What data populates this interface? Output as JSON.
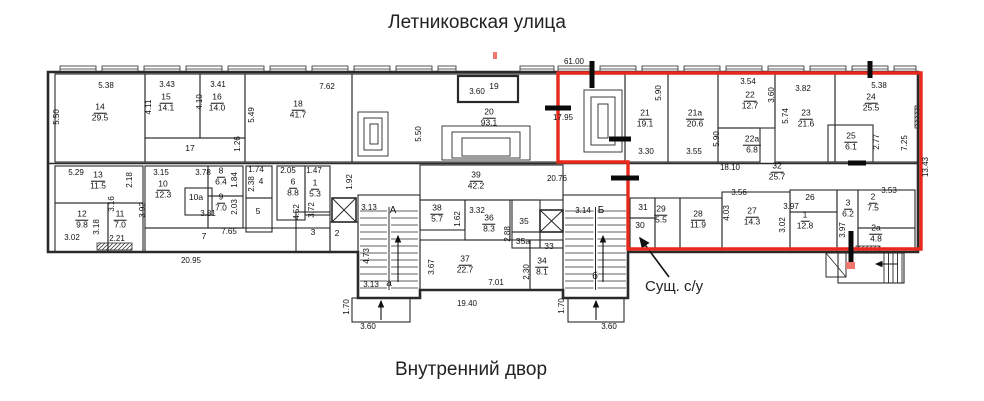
{
  "titles": {
    "top": "Летниковская улица",
    "bottom": "Внутренний двор"
  },
  "callout": {
    "text": "Сущ. с/у"
  },
  "colors": {
    "highlight": "#e8291c",
    "wall": "#2a2a2a",
    "accentTick": "#f0766e"
  },
  "plan": {
    "outline_path": "M48 72 H918 V252 H628 V298 H563 V290 H420 V298 H358 V252 H48 Z",
    "red_outline_points": "558,73 921,73 921,249 628,249 628,162 558,162",
    "rooms": [
      {
        "id": "room-14",
        "x": 55,
        "y": 74,
        "w": 90,
        "h": 88
      },
      {
        "id": "room-15",
        "x": 145,
        "y": 74,
        "w": 55,
        "h": 64
      },
      {
        "id": "room-16",
        "x": 200,
        "y": 74,
        "w": 45,
        "h": 64
      },
      {
        "id": "corridor-17",
        "x": 145,
        "y": 138,
        "w": 100,
        "h": 24
      },
      {
        "id": "room-18",
        "x": 245,
        "y": 74,
        "w": 107,
        "h": 88
      },
      {
        "id": "hall-20",
        "x": 352,
        "y": 74,
        "w": 273,
        "h": 88
      },
      {
        "id": "entrance-19",
        "x": 458,
        "y": 76,
        "w": 60,
        "h": 26,
        "bold": true
      },
      {
        "id": "room-21",
        "x": 625,
        "y": 74,
        "w": 43,
        "h": 88
      },
      {
        "id": "room-21a",
        "x": 668,
        "y": 74,
        "w": 50,
        "h": 88
      },
      {
        "id": "room-22",
        "x": 718,
        "y": 74,
        "w": 57,
        "h": 54
      },
      {
        "id": "room-22a",
        "x": 718,
        "y": 128,
        "w": 42,
        "h": 34
      },
      {
        "id": "room-23",
        "x": 775,
        "y": 74,
        "w": 60,
        "h": 88
      },
      {
        "id": "room-24",
        "x": 835,
        "y": 74,
        "w": 83,
        "h": 88
      },
      {
        "id": "room-25",
        "x": 828,
        "y": 125,
        "w": 45,
        "h": 37
      },
      {
        "id": "room-13",
        "x": 55,
        "y": 166,
        "w": 88,
        "h": 37
      },
      {
        "id": "room-12",
        "x": 55,
        "y": 203,
        "w": 53,
        "h": 49
      },
      {
        "id": "room-11",
        "x": 108,
        "y": 203,
        "w": 35,
        "h": 49
      },
      {
        "id": "room-10",
        "x": 145,
        "y": 166,
        "w": 63,
        "h": 62
      },
      {
        "id": "room-10a",
        "x": 185,
        "y": 188,
        "w": 27,
        "h": 27
      },
      {
        "id": "room-8",
        "x": 208,
        "y": 166,
        "w": 35,
        "h": 30
      },
      {
        "id": "room-9",
        "x": 208,
        "y": 196,
        "w": 35,
        "h": 32
      },
      {
        "id": "room-4",
        "x": 246,
        "y": 166,
        "w": 26,
        "h": 32
      },
      {
        "id": "room-5",
        "x": 246,
        "y": 198,
        "w": 26,
        "h": 34
      },
      {
        "id": "room-6",
        "x": 277,
        "y": 166,
        "w": 28,
        "h": 54
      },
      {
        "id": "room-1-left",
        "x": 305,
        "y": 166,
        "w": 25,
        "h": 49
      },
      {
        "id": "corridor-7",
        "x": 145,
        "y": 228,
        "w": 185,
        "h": 24
      },
      {
        "id": "room-3-left",
        "x": 296,
        "y": 212,
        "w": 34,
        "h": 40
      },
      {
        "id": "room-2-left",
        "x": 330,
        "y": 222,
        "w": 28,
        "h": 30
      },
      {
        "id": "stairs-a-box",
        "x": 358,
        "y": 195,
        "w": 62,
        "h": 103
      },
      {
        "id": "hall-39",
        "x": 420,
        "y": 165,
        "w": 143,
        "h": 35
      },
      {
        "id": "room-38",
        "x": 420,
        "y": 200,
        "w": 45,
        "h": 30
      },
      {
        "id": "room-36",
        "x": 465,
        "y": 200,
        "w": 45,
        "h": 40
      },
      {
        "id": "room-35",
        "x": 512,
        "y": 200,
        "w": 28,
        "h": 32
      },
      {
        "id": "room-35a",
        "x": 512,
        "y": 232,
        "w": 28,
        "h": 16
      },
      {
        "id": "room-33",
        "x": 540,
        "y": 232,
        "w": 23,
        "h": 16
      },
      {
        "id": "room-37",
        "x": 420,
        "y": 240,
        "w": 110,
        "h": 50
      },
      {
        "id": "room-34",
        "x": 530,
        "y": 240,
        "w": 33,
        "h": 50
      },
      {
        "id": "stairs-b-box",
        "x": 563,
        "y": 195,
        "w": 65,
        "h": 103
      },
      {
        "id": "room-31",
        "x": 630,
        "y": 198,
        "w": 25,
        "h": 20
      },
      {
        "id": "room-30",
        "x": 630,
        "y": 218,
        "w": 25,
        "h": 34
      },
      {
        "id": "room-29",
        "x": 655,
        "y": 198,
        "w": 25,
        "h": 54
      },
      {
        "id": "room-28",
        "x": 680,
        "y": 198,
        "w": 42,
        "h": 54
      },
      {
        "id": "room-27",
        "x": 722,
        "y": 192,
        "w": 68,
        "h": 60
      },
      {
        "id": "room-26",
        "x": 790,
        "y": 190,
        "w": 47,
        "h": 22
      },
      {
        "id": "room-1-right",
        "x": 790,
        "y": 212,
        "w": 47,
        "h": 40
      },
      {
        "id": "room-3-right",
        "x": 837,
        "y": 190,
        "w": 21,
        "h": 62
      },
      {
        "id": "room-2-right",
        "x": 858,
        "y": 190,
        "w": 57,
        "h": 38
      },
      {
        "id": "room-2a",
        "x": 858,
        "y": 228,
        "w": 57,
        "h": 24
      },
      {
        "id": "porch-a",
        "x": 352,
        "y": 298,
        "w": 58,
        "h": 24
      },
      {
        "id": "porch-b",
        "x": 568,
        "y": 298,
        "w": 56,
        "h": 24
      },
      {
        "id": "porch-right",
        "x": 838,
        "y": 253,
        "w": 66,
        "h": 30
      }
    ],
    "room_labels": [
      {
        "num": "14",
        "area": "29.5",
        "x": 100,
        "y": 113
      },
      {
        "num": "15",
        "area": "14.1",
        "x": 166,
        "y": 103
      },
      {
        "num": "16",
        "area": "14.0",
        "x": 217,
        "y": 103
      },
      {
        "num": "18",
        "area": "41.7",
        "x": 298,
        "y": 110
      },
      {
        "num": "20",
        "area": "93.1",
        "x": 489,
        "y": 118
      },
      {
        "num": "21",
        "area": "19.1",
        "x": 645,
        "y": 119
      },
      {
        "num": "21а",
        "area": "20.6",
        "x": 695,
        "y": 119
      },
      {
        "num": "22",
        "area": "12.7",
        "x": 750,
        "y": 101
      },
      {
        "num": "22а",
        "area": "6.8",
        "x": 752,
        "y": 145
      },
      {
        "num": "23",
        "area": "21.6",
        "x": 806,
        "y": 119
      },
      {
        "num": "24",
        "area": "25.5",
        "x": 871,
        "y": 103
      },
      {
        "num": "25",
        "area": "6.1",
        "x": 851,
        "y": 142
      },
      {
        "num": "32",
        "area": "25.7",
        "x": 777,
        "y": 172
      },
      {
        "num": "13",
        "area": "11.5",
        "x": 98,
        "y": 181
      },
      {
        "num": "12",
        "area": "9.8",
        "x": 82,
        "y": 220
      },
      {
        "num": "11",
        "area": "7.0",
        "x": 120,
        "y": 220
      },
      {
        "num": "10",
        "area": "12.3",
        "x": 163,
        "y": 190
      },
      {
        "num": "8",
        "area": "6.4",
        "x": 221,
        "y": 177
      },
      {
        "num": "9",
        "area": "7.0",
        "x": 221,
        "y": 203
      },
      {
        "num": "6",
        "area": "8.8",
        "x": 293,
        "y": 188
      },
      {
        "num": "1",
        "area": "5.3",
        "x": 315,
        "y": 189
      },
      {
        "num": "39",
        "area": "42.2",
        "x": 476,
        "y": 181
      },
      {
        "num": "38",
        "area": "5.7",
        "x": 437,
        "y": 214
      },
      {
        "num": "36",
        "area": "8.3",
        "x": 489,
        "y": 224
      },
      {
        "num": "37",
        "area": "22.7",
        "x": 465,
        "y": 265
      },
      {
        "num": "34",
        "area": "8.1",
        "x": 542,
        "y": 267
      },
      {
        "num": "29",
        "area": "5.5",
        "x": 661,
        "y": 215
      },
      {
        "num": "28",
        "area": "11.9",
        "x": 698,
        "y": 220
      },
      {
        "num": "27",
        "area": "14.3",
        "x": 752,
        "y": 217
      },
      {
        "num": "1",
        "area": "12.8",
        "x": 805,
        "y": 221
      },
      {
        "num": "3",
        "area": "6.2",
        "x": 848,
        "y": 209
      },
      {
        "num": "2",
        "area": "7.5",
        "x": 873,
        "y": 203
      },
      {
        "num": "2а",
        "area": "4.8",
        "x": 876,
        "y": 234
      }
    ],
    "plain_labels": [
      {
        "text": "17",
        "x": 190,
        "y": 148
      },
      {
        "text": "19",
        "x": 494,
        "y": 86
      },
      {
        "text": "10а",
        "x": 196,
        "y": 197
      },
      {
        "text": "4",
        "x": 261,
        "y": 181
      },
      {
        "text": "5",
        "x": 258,
        "y": 211
      },
      {
        "text": "7",
        "x": 204,
        "y": 236
      },
      {
        "text": "3",
        "x": 313,
        "y": 232
      },
      {
        "text": "2",
        "x": 337,
        "y": 233
      },
      {
        "text": "35",
        "x": 524,
        "y": 221
      },
      {
        "text": "35а",
        "x": 523,
        "y": 241
      },
      {
        "text": "33",
        "x": 549,
        "y": 246
      },
      {
        "text": "26",
        "x": 810,
        "y": 197
      },
      {
        "text": "31",
        "x": 643,
        "y": 207
      },
      {
        "text": "30",
        "x": 640,
        "y": 225
      },
      {
        "text": "А",
        "x": 393,
        "y": 211,
        "cls": "stair-letter"
      },
      {
        "text": "а",
        "x": 389,
        "y": 284,
        "cls": "stair-letter"
      },
      {
        "text": "Б",
        "x": 601,
        "y": 211,
        "cls": "stair-letter"
      },
      {
        "text": "б",
        "x": 595,
        "y": 277,
        "cls": "stair-letter"
      }
    ],
    "dims": [
      {
        "t": "5.38",
        "x": 106,
        "y": 86
      },
      {
        "t": "3.43",
        "x": 167,
        "y": 85
      },
      {
        "t": "3.41",
        "x": 218,
        "y": 85
      },
      {
        "t": "7.62",
        "x": 327,
        "y": 87
      },
      {
        "t": "3.60",
        "x": 477,
        "y": 92
      },
      {
        "t": "61.00",
        "x": 574,
        "y": 62
      },
      {
        "t": "17.95",
        "x": 563,
        "y": 118
      },
      {
        "t": "3.30",
        "x": 646,
        "y": 152
      },
      {
        "t": "3.55",
        "x": 694,
        "y": 152
      },
      {
        "t": "3.54",
        "x": 748,
        "y": 82
      },
      {
        "t": "3.82",
        "x": 803,
        "y": 89
      },
      {
        "t": "5.38",
        "x": 879,
        "y": 86
      },
      {
        "t": "18.10",
        "x": 730,
        "y": 168
      },
      {
        "t": "20.76",
        "x": 557,
        "y": 179
      },
      {
        "t": "5.29",
        "x": 76,
        "y": 173
      },
      {
        "t": "3.02",
        "x": 72,
        "y": 238
      },
      {
        "t": "2.21",
        "x": 117,
        "y": 239
      },
      {
        "t": "3.15",
        "x": 161,
        "y": 173
      },
      {
        "t": "3.78",
        "x": 203,
        "y": 173
      },
      {
        "t": "3.81",
        "x": 208,
        "y": 214
      },
      {
        "t": "1.74",
        "x": 256,
        "y": 170
      },
      {
        "t": "2.05",
        "x": 288,
        "y": 171
      },
      {
        "t": "1.47",
        "x": 314,
        "y": 171
      },
      {
        "t": "7.65",
        "x": 229,
        "y": 232
      },
      {
        "t": "20.95",
        "x": 191,
        "y": 261
      },
      {
        "t": "3.13",
        "x": 369,
        "y": 208
      },
      {
        "t": "3.13",
        "x": 371,
        "y": 285
      },
      {
        "t": "7.01",
        "x": 496,
        "y": 283
      },
      {
        "t": "3.32",
        "x": 477,
        "y": 211
      },
      {
        "t": "3.14",
        "x": 583,
        "y": 211
      },
      {
        "t": "19.40",
        "x": 467,
        "y": 304
      },
      {
        "t": "3.60",
        "x": 368,
        "y": 327
      },
      {
        "t": "3.60",
        "x": 609,
        "y": 327
      },
      {
        "t": "3.56",
        "x": 739,
        "y": 193
      },
      {
        "t": "3.97",
        "x": 791,
        "y": 207
      },
      {
        "t": "3.53",
        "x": 889,
        "y": 191
      },
      {
        "t": "5.50",
        "x": 57,
        "y": 117,
        "v": 1
      },
      {
        "t": "4.11",
        "x": 149,
        "y": 107,
        "v": 1
      },
      {
        "t": "4.10",
        "x": 200,
        "y": 102,
        "v": 1
      },
      {
        "t": "5.49",
        "x": 252,
        "y": 115,
        "v": 1
      },
      {
        "t": "1.26",
        "x": 238,
        "y": 144,
        "v": 1
      },
      {
        "t": "5.50",
        "x": 419,
        "y": 134,
        "v": 1
      },
      {
        "t": "5.90",
        "x": 659,
        "y": 93,
        "v": 1
      },
      {
        "t": "5.90",
        "x": 717,
        "y": 139,
        "v": 1
      },
      {
        "t": "3.60",
        "x": 772,
        "y": 95,
        "v": 1
      },
      {
        "t": "5.74",
        "x": 786,
        "y": 116,
        "v": 1
      },
      {
        "t": "2.77",
        "x": 877,
        "y": 142,
        "v": 1
      },
      {
        "t": "7.25",
        "x": 905,
        "y": 143,
        "v": 1
      },
      {
        "t": "13.43",
        "x": 926,
        "y": 167,
        "v": 1
      },
      {
        "t": "2.18",
        "x": 130,
        "y": 180,
        "v": 1
      },
      {
        "t": "3.18",
        "x": 97,
        "y": 227,
        "v": 1
      },
      {
        "t": "3.16",
        "x": 112,
        "y": 204,
        "v": 1
      },
      {
        "t": "3.92",
        "x": 143,
        "y": 210,
        "v": 1
      },
      {
        "t": "1.84",
        "x": 235,
        "y": 180,
        "v": 1
      },
      {
        "t": "2.03",
        "x": 235,
        "y": 207,
        "v": 1
      },
      {
        "t": "2.38",
        "x": 252,
        "y": 184,
        "v": 1
      },
      {
        "t": "4.52",
        "x": 297,
        "y": 212,
        "v": 1
      },
      {
        "t": "3.72",
        "x": 312,
        "y": 210,
        "v": 1
      },
      {
        "t": "1.92",
        "x": 350,
        "y": 182,
        "v": 1
      },
      {
        "t": "4.73",
        "x": 367,
        "y": 256,
        "v": 1
      },
      {
        "t": "1.62",
        "x": 458,
        "y": 219,
        "v": 1
      },
      {
        "t": "2.88",
        "x": 508,
        "y": 234,
        "v": 1
      },
      {
        "t": "3.67",
        "x": 432,
        "y": 267,
        "v": 1
      },
      {
        "t": "2.30",
        "x": 527,
        "y": 272,
        "v": 1
      },
      {
        "t": "1.70",
        "x": 347,
        "y": 307,
        "v": 1
      },
      {
        "t": "1.70",
        "x": 562,
        "y": 306,
        "v": 1
      },
      {
        "t": "4.03",
        "x": 727,
        "y": 213,
        "v": 1
      },
      {
        "t": "3.02",
        "x": 783,
        "y": 225,
        "v": 1
      },
      {
        "t": "3.97",
        "x": 843,
        "y": 230,
        "v": 1
      }
    ],
    "windows": [
      [
        60,
        36
      ],
      [
        102,
        36
      ],
      [
        144,
        36
      ],
      [
        186,
        36
      ],
      [
        228,
        36
      ],
      [
        270,
        36
      ],
      [
        312,
        36
      ],
      [
        354,
        36
      ],
      [
        396,
        36
      ],
      [
        438,
        18
      ],
      [
        520,
        34
      ],
      [
        558,
        36
      ],
      [
        600,
        36
      ],
      [
        642,
        36
      ],
      [
        684,
        36
      ],
      [
        726,
        36
      ],
      [
        768,
        36
      ],
      [
        810,
        36
      ],
      [
        852,
        36
      ],
      [
        894,
        22
      ]
    ],
    "xboxes": [
      [
        332,
        198,
        24,
        24
      ],
      [
        540,
        210,
        23,
        22
      ]
    ],
    "stairs": [
      [
        358,
        195,
        62,
        103
      ],
      [
        563,
        195,
        65,
        103
      ]
    ],
    "hatches": [
      [
        97,
        243,
        35,
        7
      ],
      [
        856,
        246,
        24,
        7
      ],
      [
        915,
        106,
        7,
        22
      ]
    ],
    "nested": [
      [
        [
          442,
          126,
          88,
          34
        ],
        [
          452,
          132,
          68,
          26
        ],
        [
          462,
          138,
          48,
          18
        ]
      ],
      [
        [
          358,
          112,
          30,
          44
        ],
        [
          364,
          118,
          18,
          32
        ],
        [
          370,
          124,
          8,
          20
        ]
      ],
      [
        [
          584,
          90,
          38,
          62
        ],
        [
          591,
          97,
          24,
          48
        ],
        [
          598,
          104,
          10,
          34
        ]
      ]
    ],
    "vestibule": [
      826,
      253,
      20,
      24
    ],
    "steps_right": {
      "x1": 884,
      "x2": 902,
      "y1": 253,
      "y2": 283,
      "n": 4
    },
    "arrows": [
      [
        381,
        320,
        381,
        301
      ],
      [
        596,
        320,
        596,
        301
      ],
      [
        398,
        282,
        398,
        236
      ],
      [
        603,
        282,
        603,
        236
      ],
      [
        898,
        264,
        876,
        264
      ]
    ],
    "callout_arrow": [
      669,
      277,
      640,
      238
    ],
    "black_bars": [
      [
        592,
        61,
        592,
        88
      ],
      [
        545,
        108,
        571,
        108
      ],
      [
        609,
        139,
        631,
        139
      ],
      [
        611,
        178,
        639,
        178
      ],
      [
        851,
        231,
        851,
        264
      ],
      [
        848,
        163,
        866,
        163
      ],
      [
        870,
        61,
        870,
        78
      ]
    ],
    "red_ticks": [
      [
        493,
        52,
        4,
        7
      ],
      [
        846,
        262,
        9,
        7
      ]
    ]
  }
}
